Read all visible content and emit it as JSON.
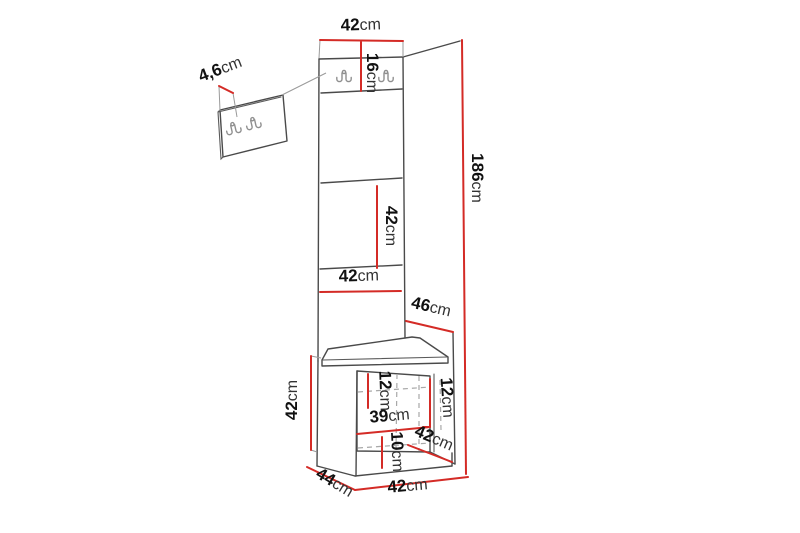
{
  "diagram_type": "furniture dimension drawing",
  "colors": {
    "dimension_line": "#d42b26",
    "outline": "#4a4a4a",
    "hidden_line": "#a8a8a8",
    "background": "#ffffff"
  },
  "icons": {
    "hook": "coat-hook"
  },
  "dimensions": {
    "top_width": {
      "value": "42",
      "unit": "cm"
    },
    "hook_panel_height": {
      "value": "16",
      "unit": "cm"
    },
    "wall_panel_thickness": {
      "value": "4,6",
      "unit": "cm"
    },
    "middle_panel_height": {
      "value": "42",
      "unit": "cm"
    },
    "lower_panel_width": {
      "value": "42",
      "unit": "cm"
    },
    "upper_depth": {
      "value": "46",
      "unit": "cm"
    },
    "total_height": {
      "value": "186",
      "unit": "cm"
    },
    "cabinet_height": {
      "value": "42",
      "unit": "cm"
    },
    "inner_top_left": {
      "value": "12",
      "unit": "cm"
    },
    "inner_top_right": {
      "value": "12",
      "unit": "cm"
    },
    "inner_width": {
      "value": "39",
      "unit": "cm"
    },
    "inner_bottom": {
      "value": "10",
      "unit": "cm"
    },
    "inner_diagonal": {
      "value": "42",
      "unit": "cm"
    },
    "cabinet_depth": {
      "value": "44",
      "unit": "cm"
    },
    "cabinet_width": {
      "value": "42",
      "unit": "cm"
    }
  }
}
